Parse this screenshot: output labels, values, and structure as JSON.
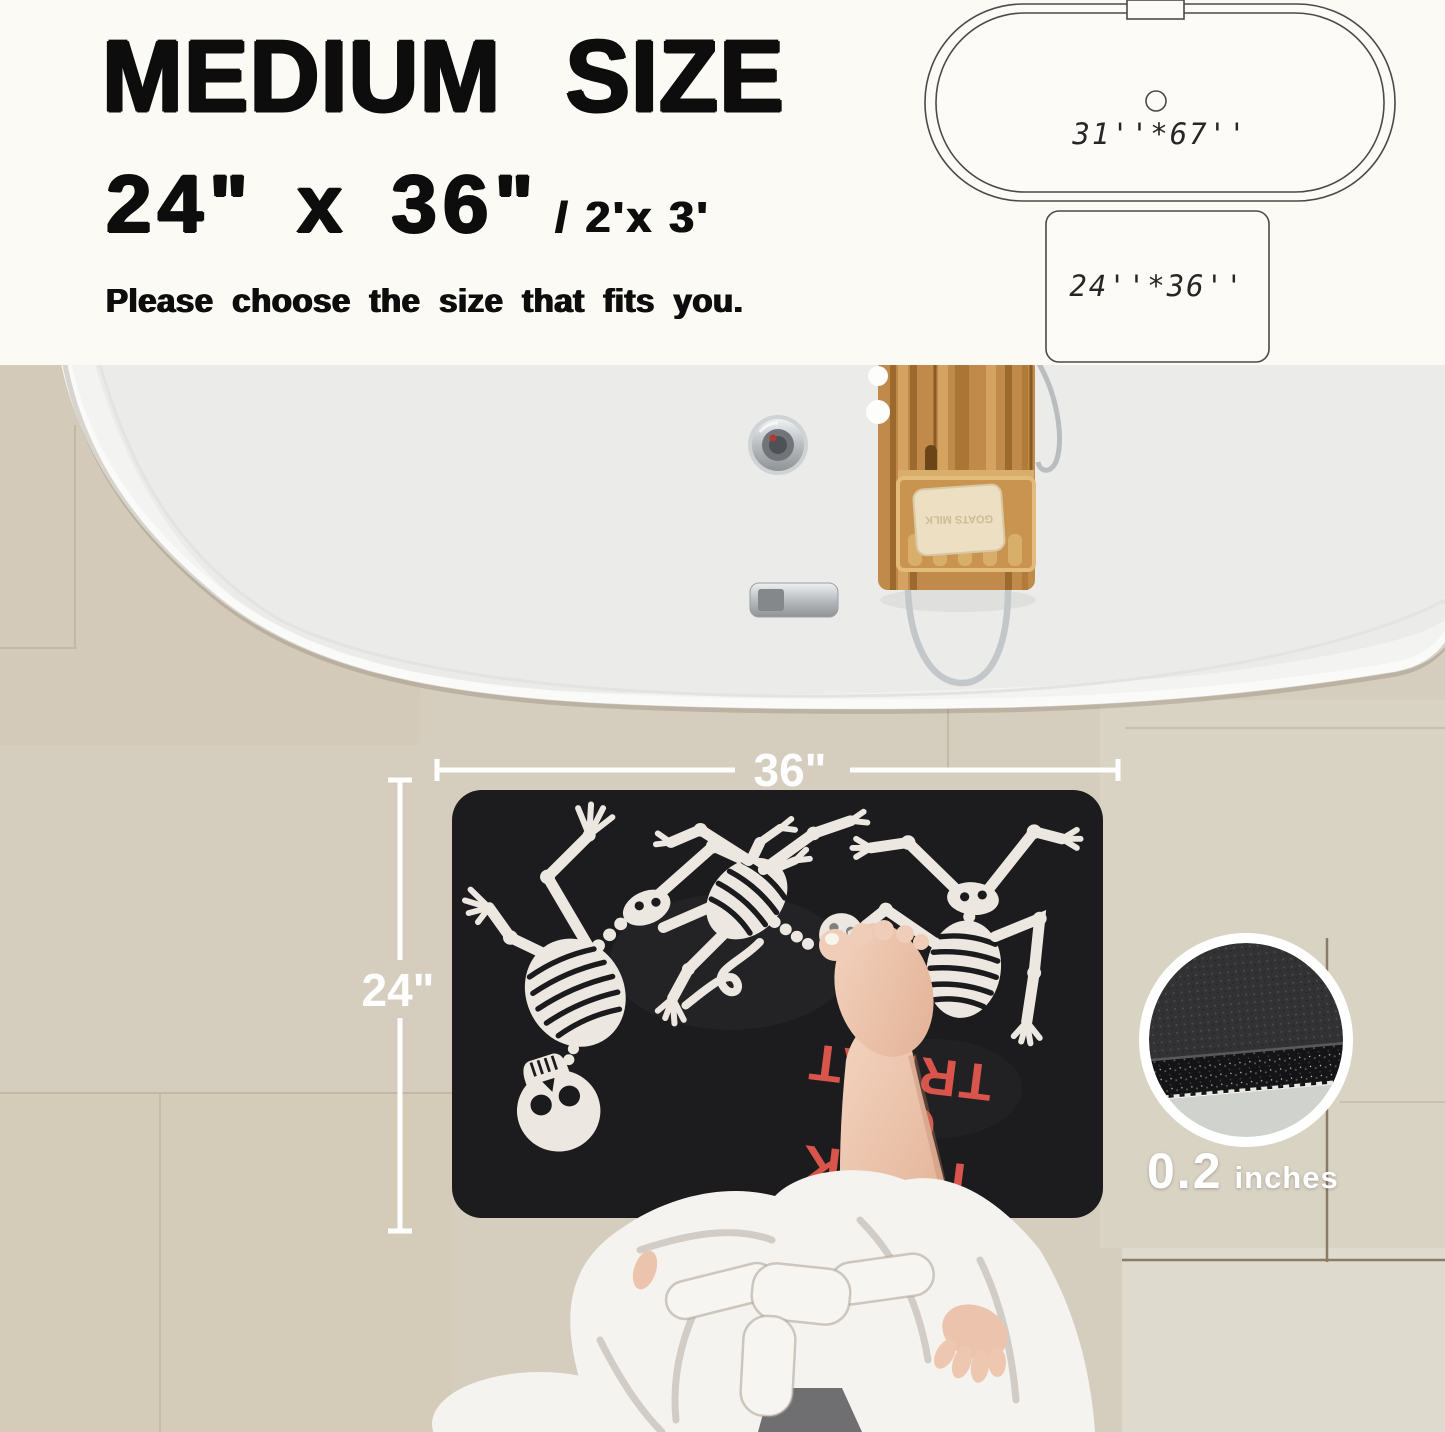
{
  "header": {
    "title": "MEDIUM SIZE",
    "size_primary": "24\"  x  36\"",
    "size_secondary": "/ 2'x 3'",
    "subtitle": "Please choose the size that fits you."
  },
  "size_diagram": {
    "tub_label": "31''*67''",
    "mat_label": "24''*36''"
  },
  "dimensions": {
    "width_label": "36\"",
    "height_label": "24\""
  },
  "thickness": {
    "value": "0.2",
    "unit": "inches"
  },
  "mat": {
    "text_lines": [
      "TRICK",
      "OR",
      "TREAT"
    ]
  },
  "soap": {
    "label": "GOATS MILK"
  },
  "colors": {
    "mat_black": "#1c1c1e",
    "accent_red": "#d9544a",
    "tile_beige": "#d5cdbe",
    "bone_white": "#ece8e1",
    "tub_white": "#f3f3f2"
  }
}
